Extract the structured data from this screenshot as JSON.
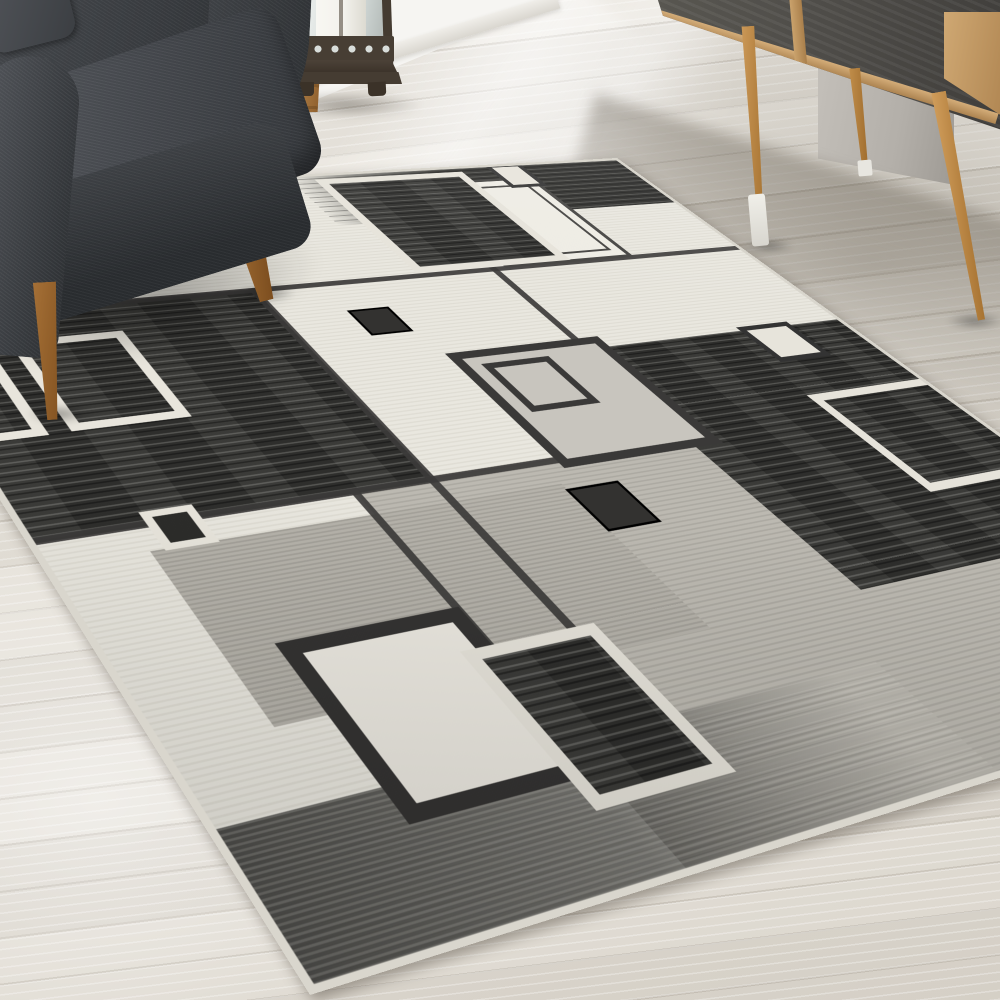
{
  "meta": {
    "image_type": "photograph",
    "description": "Living-room corner scene: modern geometric area rug with overlapping black, gray and cream squares on a whitewashed wood plank floor; charcoal fabric armchair with tapered wood legs at top-left; bronze candle lantern by the white paneled wall; mid-century sideboard with slate doors, oak frame and splayed tapered legs at top-right; soft diagonal daylight across the floor.",
    "visible_text": "none"
  },
  "palette": {
    "floor_base": "#e8e4dc",
    "floor_seam": "#cfcabf",
    "wall_white": "#f6f5f2",
    "wall_corner_gray": "#b3afa9",
    "chair_fabric": "#3c3f43",
    "chair_fabric_light": "#4d5055",
    "chair_leg_wood": "#9c672e",
    "lantern_metal": "#473e34",
    "lantern_glass": "#dfe4e2",
    "candle_white": "#f3f2ec",
    "sideboard_slate": "#504e4a",
    "sideboard_oak": "#c9a26d",
    "sideboard_leg": "#c0924f",
    "rug_cream": "#e9e7df",
    "rug_gray": "#bcb9b1",
    "rug_dark": "#2e2e2c",
    "rug_line": "#3c3b39",
    "rug_white": "#e7e4db",
    "rug_binding": "#d9d6cd",
    "rug_center_gray": "#c8c5be"
  },
  "scene": {
    "room": "living room corner",
    "floor": {
      "material": "whitewashed wood planks, diagonal seams",
      "lighting": "diagonal sunlight shafts upper area, shadow band under sideboard"
    },
    "wall": {
      "style": "white panel wall with baseboard, visible top-center; gray shadowed wall corner behind sideboard"
    },
    "armchair": {
      "position": "top-left, partially cropped",
      "fabric": "dark charcoal woven",
      "legs": "tapered mid-century wood, two visible"
    },
    "lantern": {
      "position": "floor beside chair against wall",
      "style": "bronze metal frame, glass panes, white pillar candle, circle lattice band, footed base",
      "extra": "wooden post behind"
    },
    "sideboard": {
      "position": "top-right, partially cropped",
      "style": "slate-gray door panels, oak frame and bottom rail, oak vertical divider, three visible splayed tapered legs, white protector caps on front legs"
    },
    "rug": {
      "style": "modern geometric overlapping-squares area rug, rotated in perspective",
      "pattern_elements": [
        {
          "name": "top-dark-gradient-band",
          "look": "streaked black band along top edge fading from gray"
        },
        {
          "name": "small-white-square-top",
          "look": "white square with dark outline inside top band"
        },
        {
          "name": "black-square-cream-border",
          "look": "large charcoal square with cream border at top"
        },
        {
          "name": "white-square-double-outline",
          "look": "white square with thin double dark outline overlapping black square"
        },
        {
          "name": "thin-outline-square-under-chair",
          "look": "thin dark outline square partially hidden by chair"
        },
        {
          "name": "left-black-block",
          "look": "streaked black block on left side"
        },
        {
          "name": "white-outline-square-left-1",
          "look": "white outline square on left black block"
        },
        {
          "name": "white-outline-square-left-2",
          "look": "white outline square clipped at left edge"
        },
        {
          "name": "small-dark-square-white-outline-left",
          "look": "small dark square with white outline at block lower edge"
        },
        {
          "name": "small-solid-dark-square-upper",
          "look": "small solid dark square on cream field"
        },
        {
          "name": "center-gray-square-dark-border",
          "look": "gray square with dark border and small inner outlined square"
        },
        {
          "name": "small-solid-dark-square-center",
          "look": "small solid dark square below center square"
        },
        {
          "name": "right-black-block",
          "look": "large streaked black block on right side"
        },
        {
          "name": "small-white-square-right-edge",
          "look": "small white square with dark outline at block upper edge"
        },
        {
          "name": "white-outline-square-right",
          "look": "white outline square inside right black block"
        },
        {
          "name": "bottom-cream-square-dark-border",
          "look": "cream square with thick dark border at bottom"
        },
        {
          "name": "bottom-black-square-white-border",
          "look": "black square with white border overlapping cream square"
        },
        {
          "name": "bottom-dark-gradient-band",
          "look": "streaked dark band along bottom edge"
        },
        {
          "name": "small-white-square-bottom",
          "look": "small white square with dark outline on bottom band"
        }
      ],
      "grid": "thin dark lines dividing cream and gray fields",
      "binding": "light cream serged edge"
    }
  }
}
